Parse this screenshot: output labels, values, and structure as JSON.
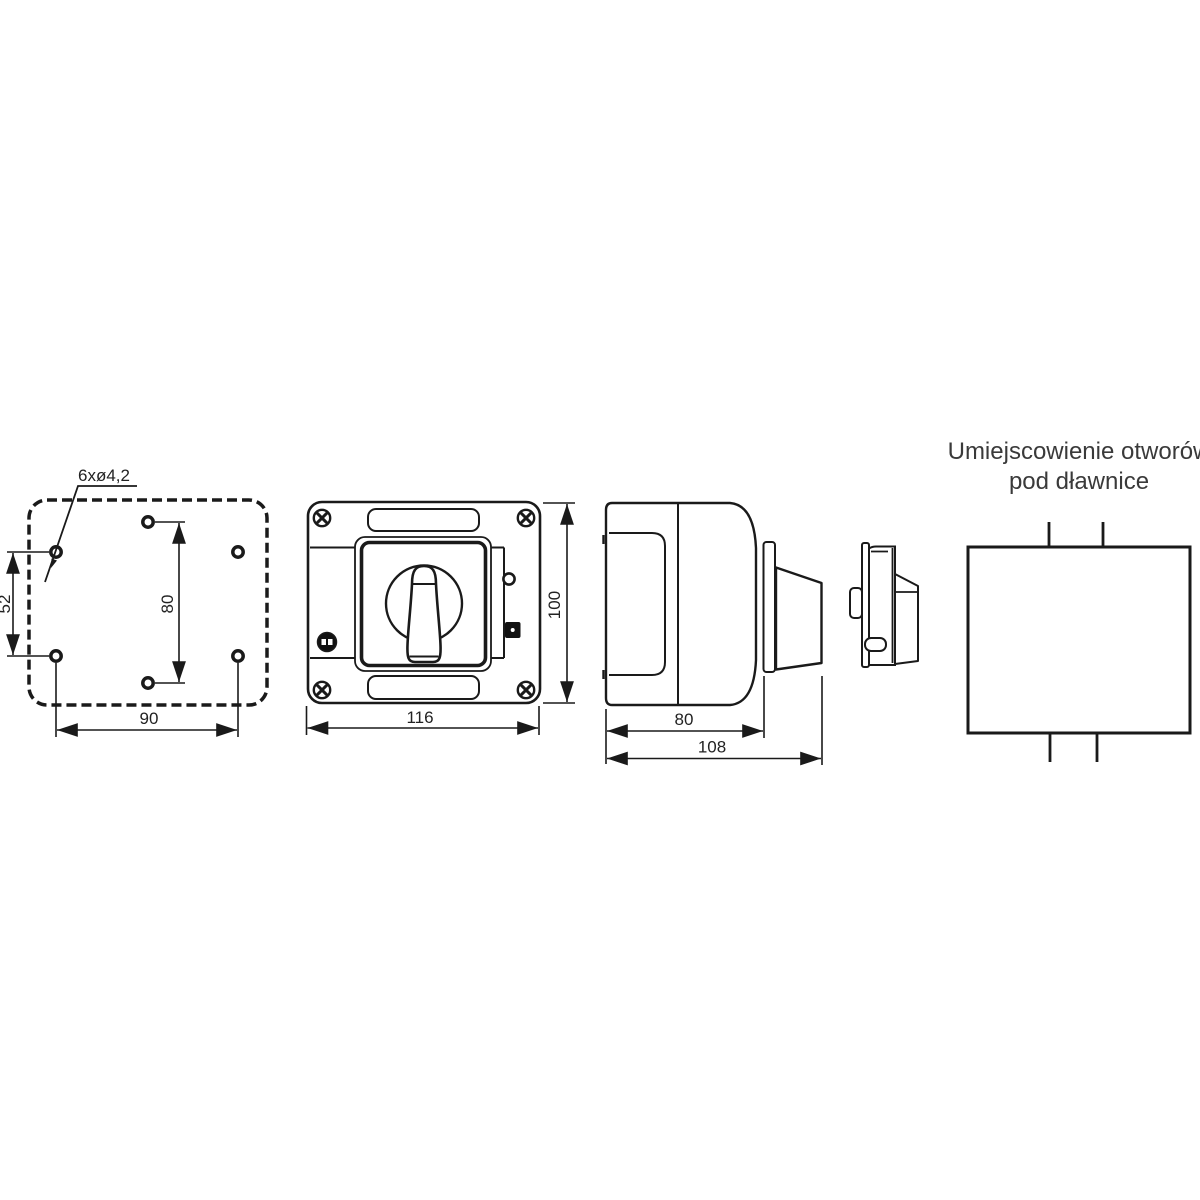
{
  "drawing": {
    "title": {
      "line1": "Umiejscowienie otworów",
      "line2": "pod dławnice"
    },
    "views": {
      "back_view": {
        "hole_callout": "6xø4,2",
        "dim_left_vertical": "52",
        "dim_center_vertical": "80",
        "dim_bottom_horizontal": "90"
      },
      "front_view": {
        "dim_width": "116",
        "dim_height": "100"
      },
      "side_view": {
        "dim_body_depth": "80",
        "dim_total_depth": "108"
      }
    },
    "icons": {
      "screw": "phillips-screw-icon",
      "ip_badge": "ip-rating-badge-icon",
      "indicator": "indicator-lamp-icon",
      "membrane_button": "membrane-button-icon"
    },
    "colors": {
      "line": "#1a1a1a",
      "text": "#222222",
      "title": "#3a3a3a",
      "background": "#ffffff"
    }
  }
}
